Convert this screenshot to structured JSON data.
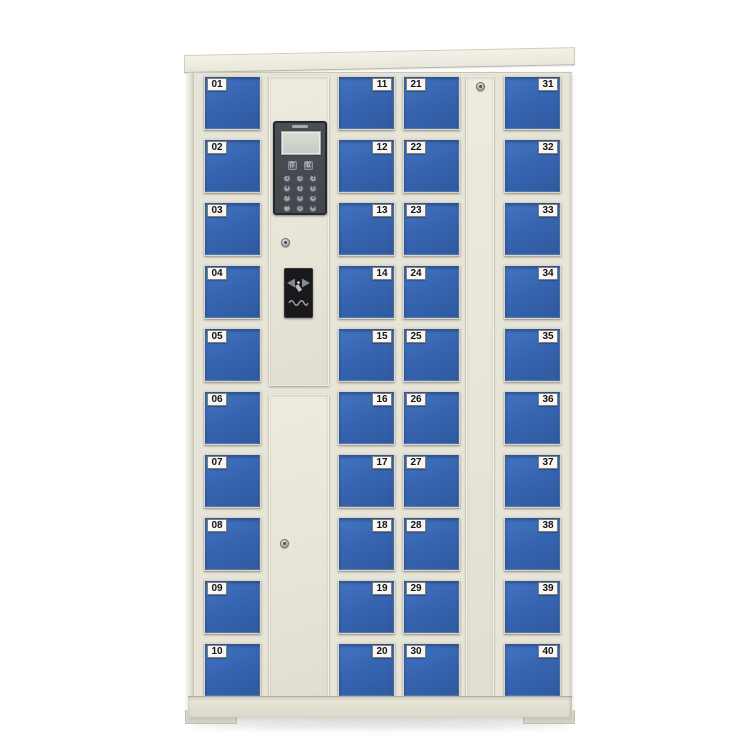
{
  "scene": {
    "background_color": "#ffffff",
    "description": "Smart electronic storage locker cabinet with 40 numbered blue doors, central control panel with LCD screen, keypad and RFID card reader"
  },
  "cabinet": {
    "colors": {
      "frame": "#e7e4d8",
      "door_blue": "#3765b2",
      "panel_body": "#45494f",
      "panel_frame": "#26282c",
      "screen": "#ccd2cb",
      "card_reader": "#19191c",
      "number_plate_bg": "#f8f7f3",
      "number_plate_text": "#141418"
    },
    "columns": [
      {
        "id": "col-1",
        "type": "doors",
        "label_side": "left",
        "numbers": [
          "01",
          "02",
          "03",
          "04",
          "05",
          "06",
          "07",
          "08",
          "09",
          "10"
        ]
      },
      {
        "id": "col-2",
        "type": "control"
      },
      {
        "id": "col-3",
        "type": "doors",
        "label_side": "right",
        "numbers": [
          "11",
          "12",
          "13",
          "14",
          "15",
          "16",
          "17",
          "18",
          "19",
          "20"
        ]
      },
      {
        "id": "col-4",
        "type": "doors",
        "label_side": "left",
        "numbers": [
          "21",
          "22",
          "23",
          "24",
          "25",
          "26",
          "27",
          "28",
          "29",
          "30"
        ]
      },
      {
        "id": "col-5",
        "type": "service"
      },
      {
        "id": "col-6",
        "type": "doors",
        "label_side": "right",
        "numbers": [
          "31",
          "32",
          "33",
          "34",
          "35",
          "36",
          "37",
          "38",
          "39",
          "40"
        ]
      }
    ],
    "control_panel": {
      "function_keys": [
        {
          "name": "deposit-key",
          "label": "存"
        },
        {
          "name": "retrieve-key",
          "label": "取"
        }
      ],
      "keypad": [
        "1",
        "2",
        "3",
        "4",
        "5",
        "6",
        "7",
        "8",
        "9",
        "*",
        "0",
        "#"
      ]
    }
  }
}
